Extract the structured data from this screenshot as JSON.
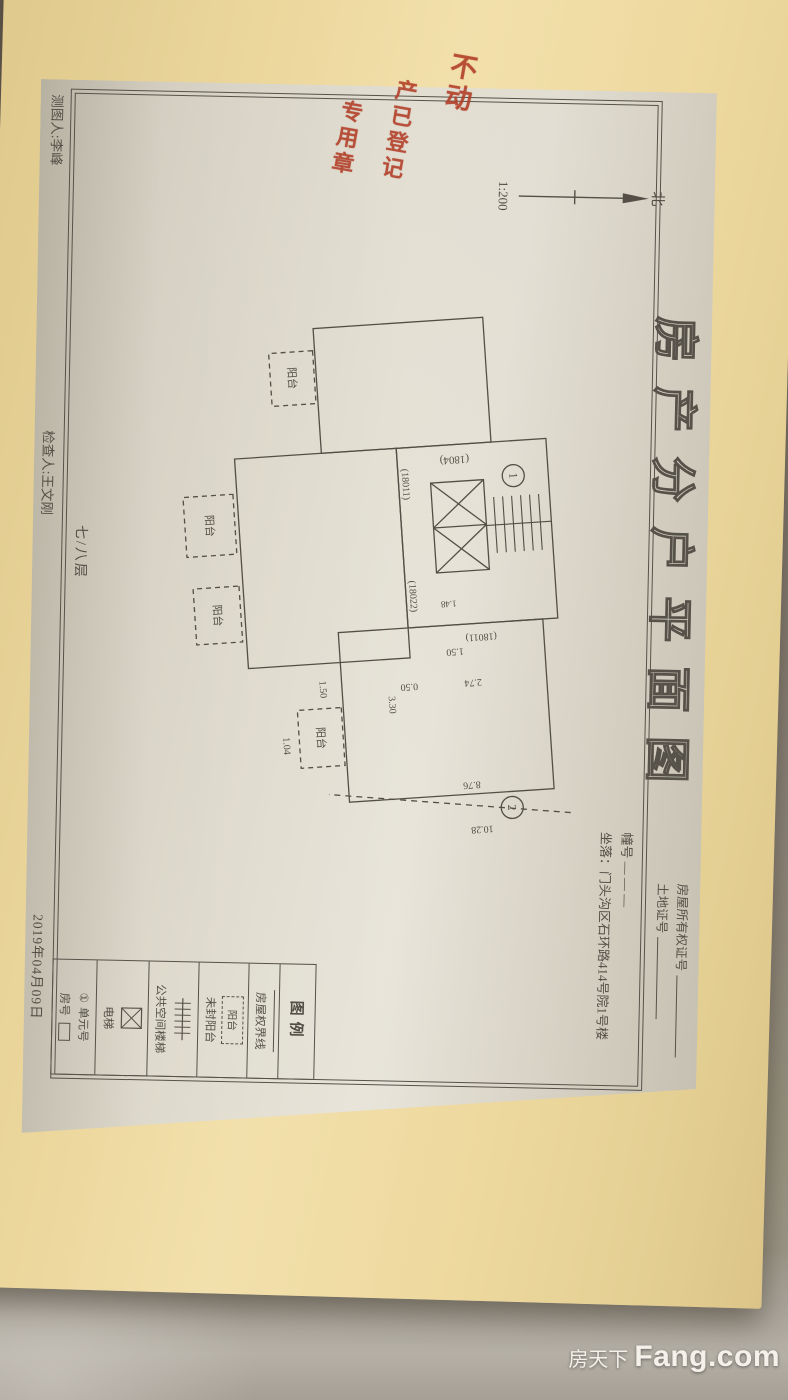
{
  "photo": {
    "colors": {
      "folder_yellow": "#eed9a0",
      "sheet_paper": "#ddd8cb",
      "ink": "#534f46",
      "stamp_red": "#b23e28",
      "background": "#8a8177"
    }
  },
  "document": {
    "title": "房产分户平面图",
    "header": {
      "cert1_label": "房屋所有权证号",
      "cert2_label": "土地证号",
      "building_label": "幢号",
      "building_value": "— — —",
      "location": "坐落：门头沟区石环路414号院1号楼"
    },
    "compass": {
      "north": "北",
      "scale": "1:200"
    },
    "floor_label": "七/八层",
    "plan": {
      "unit1": "1",
      "unit2": "2",
      "balcony": "阳台",
      "codes": {
        "c1804": "(1804)",
        "c18011": "(18011)",
        "c18022": "(18022)"
      },
      "dims": {
        "d274": "2.74",
        "d050": "0.50",
        "d330": "3.30",
        "d150": "1.50",
        "d104": "1.04",
        "d876": "8.76",
        "d1028": "10.28",
        "d148": "1.48"
      }
    },
    "legend": {
      "title": "图例",
      "unit_symbol": "①",
      "items": [
        {
          "label": "房屋权界线"
        },
        {
          "label": "阳台"
        },
        {
          "label": "未封阳台"
        },
        {
          "label": "公共空间楼梯"
        },
        {
          "label": "电梯"
        },
        {
          "label": "单元号"
        },
        {
          "label": "房号"
        }
      ]
    },
    "footer": {
      "drafter": "测图人:李峰",
      "checker": "检查人:王文刚",
      "date": "2019年04月09日"
    }
  },
  "stamp": {
    "col1": "不动",
    "col2": "产已登记",
    "col3": "专用章"
  },
  "watermark": {
    "cn": "房天下",
    "en": "Fang.com"
  }
}
